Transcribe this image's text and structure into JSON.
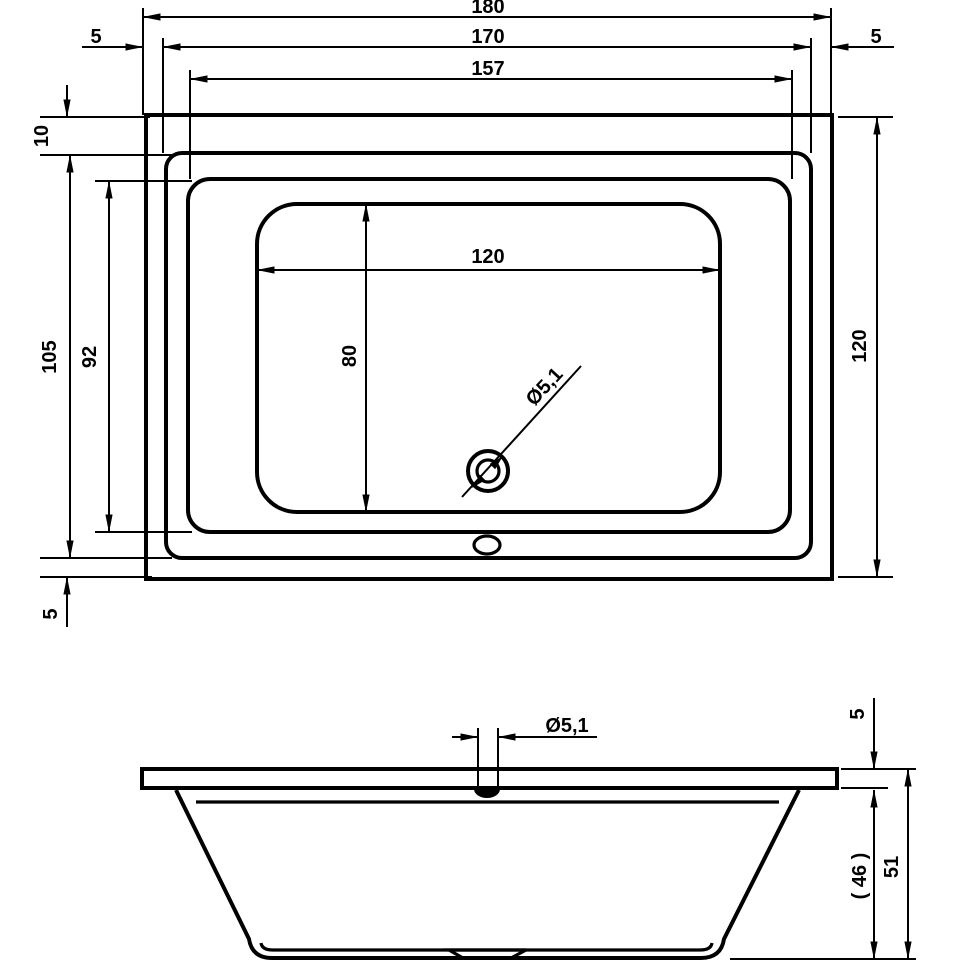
{
  "drawing": {
    "type": "bathtub-technical-drawing",
    "line_color": "#000000",
    "background_color": "#ffffff"
  },
  "plan_view": {
    "dims": {
      "overall_width": "180",
      "edge_left": "5",
      "width_170": "170",
      "width_157": "157",
      "edge_right": "5",
      "edge_top": "10",
      "length_105": "105",
      "length_92": "92",
      "edge_bottom": "5",
      "overall_depth": "120",
      "basin_width": "120",
      "basin_depth": "80",
      "drain_diameter": "Ø5,1"
    }
  },
  "side_view": {
    "dims": {
      "drain_diameter": "Ø5,1",
      "rim_thickness": "5",
      "inner_depth": "( 46 )",
      "overall_height": "51"
    }
  }
}
